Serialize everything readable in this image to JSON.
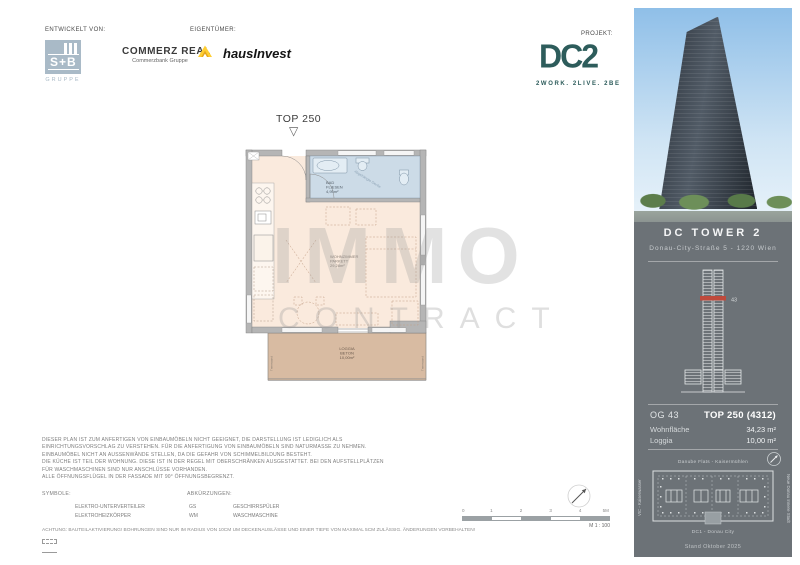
{
  "colors": {
    "dc2_teal": "#2d5c5b",
    "commerzbank_yellow": "#ffce32",
    "sb_blue": "#a9bac7",
    "sidebar_gray": "#6c7277",
    "bath_blue": "#ccdbe7",
    "interior_peach": "#faeadd",
    "loggia_tan": "#d8bba2",
    "floor_marker_red": "#bf4a3c"
  },
  "header": {
    "developed_by_label": "ENTWICKELT VON:",
    "owner_label": "EIGENTÜMER:",
    "project_label": "PROJEKT:",
    "sb": {
      "initials": "S+B",
      "group": "GRUPPE"
    },
    "commerz_real": {
      "name": "COMMERZ REAL",
      "subtitle": "Commerzbank Gruppe"
    },
    "hausinvest": "hausInvest",
    "dc2": {
      "wordmark": "DC2",
      "tagline": "2WORK. 2LIVE. 2BE"
    }
  },
  "plan": {
    "unit_title": "TOP 250",
    "watermark_line1": "IMMO",
    "watermark_line2": "CONTRACT",
    "rooms": {
      "bath": {
        "name": "BAD",
        "finish": "FLIESEN",
        "area": "4,95m²",
        "note": "Abgehängte Decke"
      },
      "living": {
        "name": "WOHNZIMMER",
        "finish": "PARKETT",
        "area": "29,28m²"
      },
      "loggia": {
        "name": "LOGGIA",
        "finish": "BETON",
        "area": "10,00m²",
        "side_label": "Trennwand"
      }
    }
  },
  "disclaimer": {
    "lines": [
      "DIESER PLAN IST ZUM ANFERTIGEN VON EINBAUMÖBELN NICHT GEEIGNET, DIE DARSTELLUNG IST LEDIGLICH ALS",
      "EINRICHTUNGSVORSCHLAG ZU VERSTEHEN. FÜR DIE ANFERTIGUNG VON EINBAUMÖBELN SIND NATURMASSE ZU NEHMEN.",
      "EINBAUMÖBEL NICHT AN AUSSENWÄNDE STELLEN, DA DIE GEFAHR VON SCHIMMELBILDUNG BESTEHT.",
      "DIE KÜCHE IST TEIL DER WOHNUNG. DIESE IST IN DER REGEL MIT OBERSCHRÄNKEN AUSGESTATTET. BEI DEN AUFSTELLPLÄTZEN",
      "FÜR WASCHMASCHINEN SIND NUR ANSCHLÜSSE VORHANDEN.",
      "ALLE ÖFFNUNGSFLÜGEL IN DER FASSADE MIT 90° ÖFFNUNGSBEGRENZT."
    ]
  },
  "legend": {
    "symbols_title": "SYMBOLE:",
    "abbreviations_title": "ABKÜRZUNGEN:",
    "symbols": [
      {
        "label": "ELEKTRO-UNTERVERTEILER"
      },
      {
        "label": "ELEKTROHEIZKÖRPER"
      }
    ],
    "abbreviations": [
      {
        "abbr": "GS",
        "label": "GESCHIRRSPÜLER"
      },
      {
        "abbr": "WM",
        "label": "WASCHMASCHINE"
      }
    ]
  },
  "warning": "ACHTUNG: BAUTEILAKTIVIERUNG! BOHRUNGEN SIND NUR IM RADIUS VON 10CM UM DECKENAUSLÄSSE UND EINER TIEFE VON MAXIMAL 5CM ZULÄSSIG. ÄNDERUNGEN VORBEHALTEN!",
  "scalebar": {
    "ticks": [
      "0",
      "1",
      "2",
      "3",
      "4",
      "5M"
    ],
    "scale_label": "M 1 : 100"
  },
  "sidebar": {
    "title": "DC TOWER 2",
    "address": "Donau-City-Straße 5 - 1220 Wien",
    "floor_marker": "43",
    "floor_label": "OG 43",
    "unit_label": "TOP 250 (4312)",
    "rows": [
      {
        "label": "Wohnfläche",
        "value": "34,23 m²"
      },
      {
        "label": "Loggia",
        "value": "10,00 m²"
      }
    ],
    "site": {
      "top": "Danube Flats - Kaisermühlen",
      "left": "VIC - Kaiserwasser",
      "right": "Neue Donau Innere Stadt",
      "bottom": "DC1 - Donau City"
    },
    "stand": "Stand Oktober 2025"
  }
}
